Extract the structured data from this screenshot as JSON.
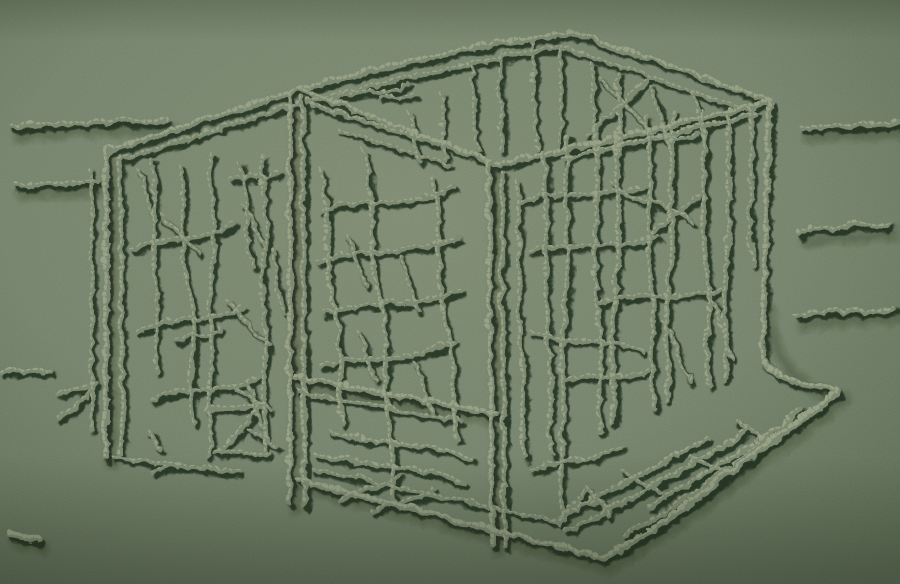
{
  "meta": {
    "title": "Monochrome green relief artwork: transparent box filled with branches in a sparse landscape",
    "medium": "raised granular line relief on sage-green ground"
  },
  "palette": {
    "base": "#73806b",
    "vignette_inner": "#7e8a72",
    "vignette_mid": "#72806a",
    "vignette_outer": "#54624c",
    "line_body": "#7d8971",
    "line_highlight": "#9aa489",
    "line_shadow": "#1f2a1b",
    "cast_shadow": "#243018"
  },
  "artwork": {
    "strokes": [
      {
        "d": "M104,150 L104,456",
        "w": 6
      },
      {
        "d": "M119,157 L121,452",
        "w": 5
      },
      {
        "d": "M90,168 L90,428",
        "w": 4
      },
      {
        "d": "M104,150 L298,88",
        "w": 6
      },
      {
        "d": "M117,159 L300,101",
        "w": 4.5
      },
      {
        "d": "M288,92 L288,500",
        "w": 6
      },
      {
        "d": "M301,97 L303,504",
        "w": 5
      },
      {
        "d": "M298,88 C390,62 480,42 568,32",
        "w": 6
      },
      {
        "d": "M568,32 C640,52 706,79 770,100",
        "w": 6
      },
      {
        "d": "M307,101 C400,76 490,57 561,45",
        "w": 4.5
      },
      {
        "d": "M561,45 L752,111",
        "w": 4.5
      },
      {
        "d": "M298,88 C365,112 430,138 490,161",
        "w": 6
      },
      {
        "d": "M311,104 L447,144",
        "w": 5
      },
      {
        "d": "M339,129 L449,164",
        "w": 4.5
      },
      {
        "d": "M770,100 C680,122 580,146 494,163",
        "w": 6
      },
      {
        "d": "M755,113 C690,127 625,143 562,157",
        "w": 5
      },
      {
        "d": "M487,163 L490,542",
        "w": 6
      },
      {
        "d": "M500,171 L503,544",
        "w": 5
      },
      {
        "d": "M768,103 C765,190 763,290 762,356 C764,374 798,382 836,390",
        "w": 6
      },
      {
        "d": "M297,478 C400,504 510,534 602,557",
        "w": 6.5
      },
      {
        "d": "M602,557 C680,514 766,441 836,391",
        "w": 6.5
      },
      {
        "d": "M311,468 C390,485 470,502 558,520",
        "w": 4.5
      },
      {
        "d": "M622,534 C688,500 748,452 800,408",
        "w": 4.5
      },
      {
        "d": "M294,376 C360,388 430,400 495,412",
        "w": 6
      },
      {
        "d": "M297,391 C350,400 405,410 458,420",
        "w": 4.5
      },
      {
        "d": "M112,456 L238,471",
        "w": 4
      },
      {
        "d": "M10,126 C60,119 120,123 168,118",
        "w": 5
      },
      {
        "d": "M14,184 L96,180",
        "w": 5
      },
      {
        "d": "M0,371 C16,367 34,372 48,369",
        "w": 5
      },
      {
        "d": "M10,532 C20,534 28,536 38,538",
        "w": 7
      },
      {
        "d": "M800,126 L896,122",
        "w": 5
      },
      {
        "d": "M798,233 C812,220 828,232 844,224 C858,217 872,229 888,223",
        "w": 5
      },
      {
        "d": "M795,316 C820,305 852,315 892,307",
        "w": 5
      },
      {
        "d": "M57,392 C70,385 82,389 93,384 L74,405 C69,412 62,410 57,416",
        "w": 4.5
      },
      {
        "d": "M148,430 C156,434 150,442 158,447",
        "w": 4
      },
      {
        "d": "M205,409 C228,401 246,409 263,402 L216,452 C236,447 252,458 268,451",
        "w": 4.5
      },
      {
        "d": "M150,470 L178,462",
        "w": 4
      },
      {
        "d": "M232,384 L268,408",
        "w": 4
      },
      {
        "d": "M247,428 L277,446",
        "w": 4
      },
      {
        "d": "M150,158 C158,200 146,242 154,282 C158,312 150,342 155,370",
        "w": 4.5
      },
      {
        "d": "M178,165 C186,210 176,252 188,296 C196,332 186,372 192,420",
        "w": 4.5
      },
      {
        "d": "M210,152 C205,192 218,226 210,264 C204,302 214,342 208,392 C205,422 212,442 209,456",
        "w": 4.5
      },
      {
        "d": "M238,162 C250,196 240,232 252,268",
        "w": 4.5
      },
      {
        "d": "M262,155 C258,186 270,216 262,252 C256,286 268,322 262,362 C258,396 266,426 262,450",
        "w": 4.5
      },
      {
        "d": "M130,248 C165,231 200,243 233,222",
        "w": 4.5
      },
      {
        "d": "M136,330 C170,311 206,326 241,305",
        "w": 4.5
      },
      {
        "d": "M150,398 C185,381 221,396 256,375",
        "w": 4.5
      },
      {
        "d": "M160,215 C175,228 186,240 198,251",
        "w": 4
      },
      {
        "d": "M225,300 C240,315 253,330 268,346",
        "w": 4
      },
      {
        "d": "M175,340 C190,330 205,339 219,327",
        "w": 4
      },
      {
        "d": "M230,180 C248,171 262,182 277,172",
        "w": 4
      },
      {
        "d": "M240,205 C255,215 250,232 263,243",
        "w": 4
      },
      {
        "d": "M270,250 C280,271 272,292 283,313",
        "w": 4
      },
      {
        "d": "M245,380 C258,395 250,412 263,429",
        "w": 4
      },
      {
        "d": "M136,170 C148,185 142,201 153,215",
        "w": 4
      },
      {
        "d": "M320,168 C332,220 318,268 336,316 C344,350 332,386 341,421",
        "w": 5
      },
      {
        "d": "M362,150 C378,206 362,256 380,306 C390,346 378,392 390,438 C394,462 388,478 392,497",
        "w": 5
      },
      {
        "d": "M430,176 C444,230 430,286 448,338 C456,372 446,406 456,437",
        "w": 5
      },
      {
        "d": "M320,210 C360,196 402,207 452,187",
        "w": 4.5
      },
      {
        "d": "M316,260 C355,245 396,258 456,236",
        "w": 4.5
      },
      {
        "d": "M322,312 C360,297 400,311 458,288",
        "w": 4.5
      },
      {
        "d": "M318,366 C355,351 396,365 452,341",
        "w": 4.5
      },
      {
        "d": "M345,235 C358,250 352,268 365,283",
        "w": 4
      },
      {
        "d": "M398,255 C410,272 404,292 417,309",
        "w": 4
      },
      {
        "d": "M356,330 C368,345 362,362 375,379",
        "w": 4
      },
      {
        "d": "M412,360 C424,376 418,394 431,411",
        "w": 4
      },
      {
        "d": "M330,430 C370,445 412,436 470,458",
        "w": 5
      },
      {
        "d": "M316,452 C356,467 398,458 462,481",
        "w": 5
      },
      {
        "d": "M340,498 C360,480 381,492 399,474",
        "w": 4.5
      },
      {
        "d": "M370,512 C390,494 411,506 431,488",
        "w": 4.5
      },
      {
        "d": "M515,180 C523,242 511,302 521,362 C525,397 517,427 523,456",
        "w": 5
      },
      {
        "d": "M542,150 C550,216 538,282 548,346 C552,386 544,422 550,453",
        "w": 5
      },
      {
        "d": "M568,135 C560,202 572,262 562,326 C556,372 566,412 560,449 C556,476 564,502 561,523",
        "w": 5
      },
      {
        "d": "M592,128 C600,192 588,256 598,321 C602,361 594,396 600,431",
        "w": 5
      },
      {
        "d": "M618,120 C610,181 622,246 612,311 C606,351 616,389 611,421",
        "w": 5
      },
      {
        "d": "M645,118 C653,176 641,236 651,296 C655,336 647,373 653,406",
        "w": 5
      },
      {
        "d": "M672,112 C664,171 676,231 666,289 C660,331 670,366 665,399",
        "w": 5
      },
      {
        "d": "M700,112 C708,166 696,223 706,279 C710,319 702,353 708,386",
        "w": 5
      },
      {
        "d": "M728,108 C722,161 732,216 724,269 C718,311 728,346 723,379",
        "w": 5
      },
      {
        "d": "M748,108 C754,159 744,211 752,263",
        "w": 4.5
      },
      {
        "d": "M520,200 C560,187 600,199 641,185",
        "w": 4.5
      },
      {
        "d": "M530,250 C570,237 611,251 656,235",
        "w": 4.5
      },
      {
        "d": "M610,180 C640,211 661,191 691,221",
        "w": 4.5
      },
      {
        "d": "M640,240 L701,191",
        "w": 4.5
      },
      {
        "d": "M600,300 C640,289 681,301 721,289",
        "w": 4.5
      },
      {
        "d": "M530,330 C570,346 601,333 641,349",
        "w": 4.5
      },
      {
        "d": "M660,320 C680,340 673,361 691,379",
        "w": 4.5
      },
      {
        "d": "M710,300 C724,318 717,339 731,356",
        "w": 4.5
      },
      {
        "d": "M560,380 C590,369 616,381 646,369",
        "w": 4.5
      },
      {
        "d": "M530,470 C560,454 591,463 621,446",
        "w": 4.5
      },
      {
        "d": "M440,92 C444,116 438,136 445,158",
        "w": 4
      },
      {
        "d": "M470,65 C476,96 468,123 477,150",
        "w": 4
      },
      {
        "d": "M500,55 C494,86 504,113 499,148",
        "w": 4
      },
      {
        "d": "M530,42 C536,76 528,109 537,148",
        "w": 4
      },
      {
        "d": "M560,48 C554,81 564,111 559,145",
        "w": 4
      },
      {
        "d": "M590,62 C596,93 588,119 597,148",
        "w": 4
      },
      {
        "d": "M618,72 C612,99 622,123 617,150",
        "w": 4
      },
      {
        "d": "M585,135 L646,78",
        "w": 4
      },
      {
        "d": "M598,75 L652,133",
        "w": 4
      },
      {
        "d": "M650,85 C662,106 656,126 669,143",
        "w": 4
      },
      {
        "d": "M690,92 C700,111 694,129 705,146",
        "w": 4
      },
      {
        "d": "M408,112 C416,131 410,147 419,161",
        "w": 4
      },
      {
        "d": "M378,96 C390,91 401,101 413,94",
        "w": 4
      },
      {
        "d": "M640,140 C660,131 677,141 695,133",
        "w": 4
      },
      {
        "d": "M330,98 C355,87 381,95 406,84",
        "w": 4
      },
      {
        "d": "M560,515 C610,488 660,462 706,436",
        "w": 5
      },
      {
        "d": "M600,512 C650,485 700,458 748,430",
        "w": 5
      },
      {
        "d": "M648,505 C695,477 742,450 788,420",
        "w": 5
      },
      {
        "d": "M565,530 L601,512",
        "w": 4.5
      },
      {
        "d": "M563,512 L586,488 L608,514",
        "w": 4.5
      },
      {
        "d": "M572,503 L599,501",
        "w": 4
      },
      {
        "d": "M620,470 L661,492",
        "w": 4.5
      },
      {
        "d": "M690,455 L726,472",
        "w": 4.5
      },
      {
        "d": "M735,420 L769,440",
        "w": 4.5
      }
    ],
    "cast": [
      "M297,480 C400,506 510,536 602,559",
      "M602,559 C680,516 766,443 836,393",
      "M294,378 C360,390 430,402 495,414",
      "M798,235 C828,226 858,230 888,225",
      "M795,318 C830,309 860,315 892,309",
      "M10,128 C60,121 120,125 168,120",
      "M14,186 L96,182",
      "M800,128 L896,124",
      "M104,152 L104,456",
      "M288,94 L288,500",
      "M487,165 L490,542",
      "M762,300 C763,360 800,384 836,391",
      "M10,534 C20,536 28,538 38,540"
    ]
  }
}
